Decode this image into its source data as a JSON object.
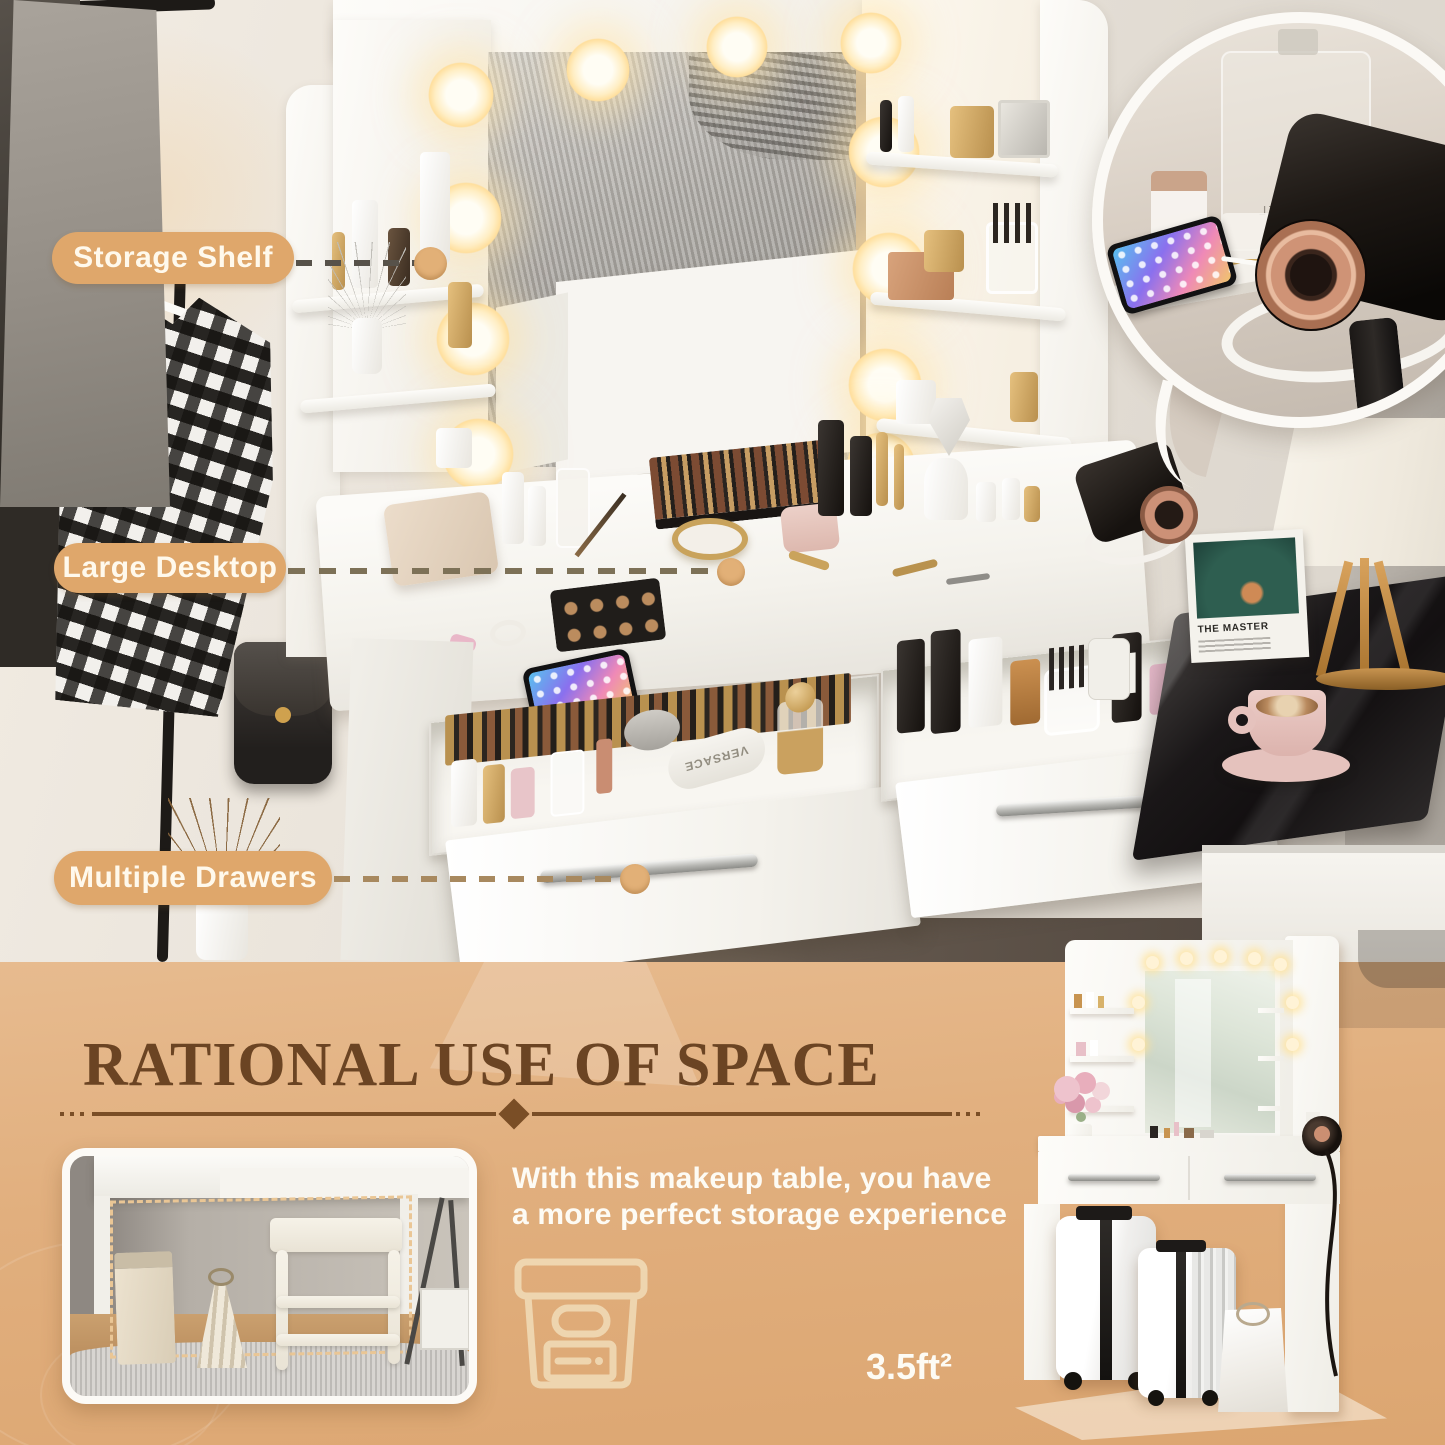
{
  "callouts": {
    "storage_shelf": "Storage Shelf",
    "large_desktop": "Large Desktop",
    "multiple_drawers": "Multiple Drawers"
  },
  "info_section": {
    "title": "RATIONAL USE OF SPACE",
    "desc_line1": "With this makeup table, you have",
    "desc_line2": "a more perfect storage experience",
    "footprint": "3.5ft²"
  },
  "photo_details": {
    "record_title": "THE MASTER",
    "perfume_brand": "CHANEL",
    "tube_brand": "VERSACE"
  },
  "colors": {
    "callout_pill": "#dfa76b",
    "callout_dot": "#e2b077",
    "panel_tan": "#e0ad7c",
    "heading_brown": "#6b4423",
    "divider_brown": "#7a4e26",
    "text_white": "#fdfbf4"
  }
}
